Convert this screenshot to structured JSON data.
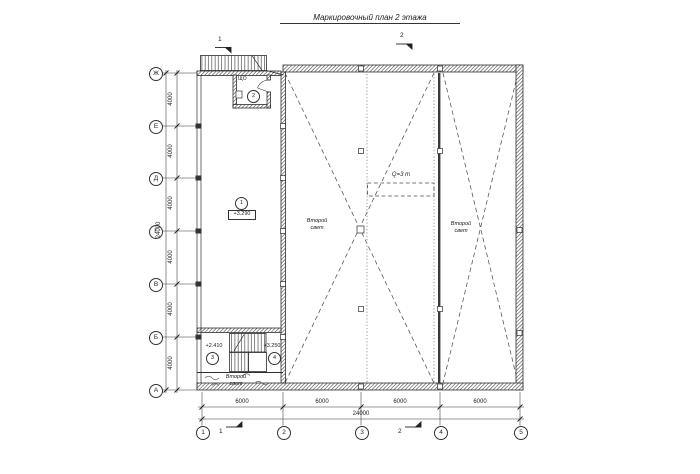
{
  "title": "Маркировочный план 2 этажа",
  "section_marks": {
    "top_1": "1",
    "top_2": "2",
    "bottom_1": "1",
    "bottom_2": "2"
  },
  "grid": {
    "row_axes": [
      {
        "label": "Ж"
      },
      {
        "label": "Е"
      },
      {
        "label": "Д"
      },
      {
        "label": "Г"
      },
      {
        "label": "В"
      },
      {
        "label": "Б"
      },
      {
        "label": "А"
      }
    ],
    "col_axes": [
      {
        "label": "1"
      },
      {
        "label": "2"
      },
      {
        "label": "3"
      },
      {
        "label": "4"
      },
      {
        "label": "5"
      }
    ]
  },
  "dimensions": {
    "left_segments": [
      "4000",
      "4000",
      "4000",
      "4000",
      "4000",
      "4000"
    ],
    "left_total": "24000",
    "bottom_segments": [
      "6000",
      "6000",
      "6000",
      "6000"
    ],
    "bottom_total": "24000"
  },
  "rooms": {
    "room1": {
      "number": "1",
      "elevation": "+3.290"
    },
    "room2": {
      "number": "2",
      "equipment_label": "ЩО"
    },
    "room3": {
      "number": "3",
      "elevation": "+2.410"
    },
    "room4": {
      "number": "4",
      "elevation": "+3.250"
    }
  },
  "annotations": {
    "second_light_left": "Второй свет",
    "second_light_mid": "Второй свет",
    "second_light_right": "Второй свет",
    "crane_capacity": "Q=3 т"
  },
  "colors": {
    "line": "#2e2e2e",
    "wall_hatch": "#4a4a4a",
    "bracing_dash": "#5a5a5a",
    "rail_dot": "#8c8c8c",
    "background": "#ffffff"
  }
}
